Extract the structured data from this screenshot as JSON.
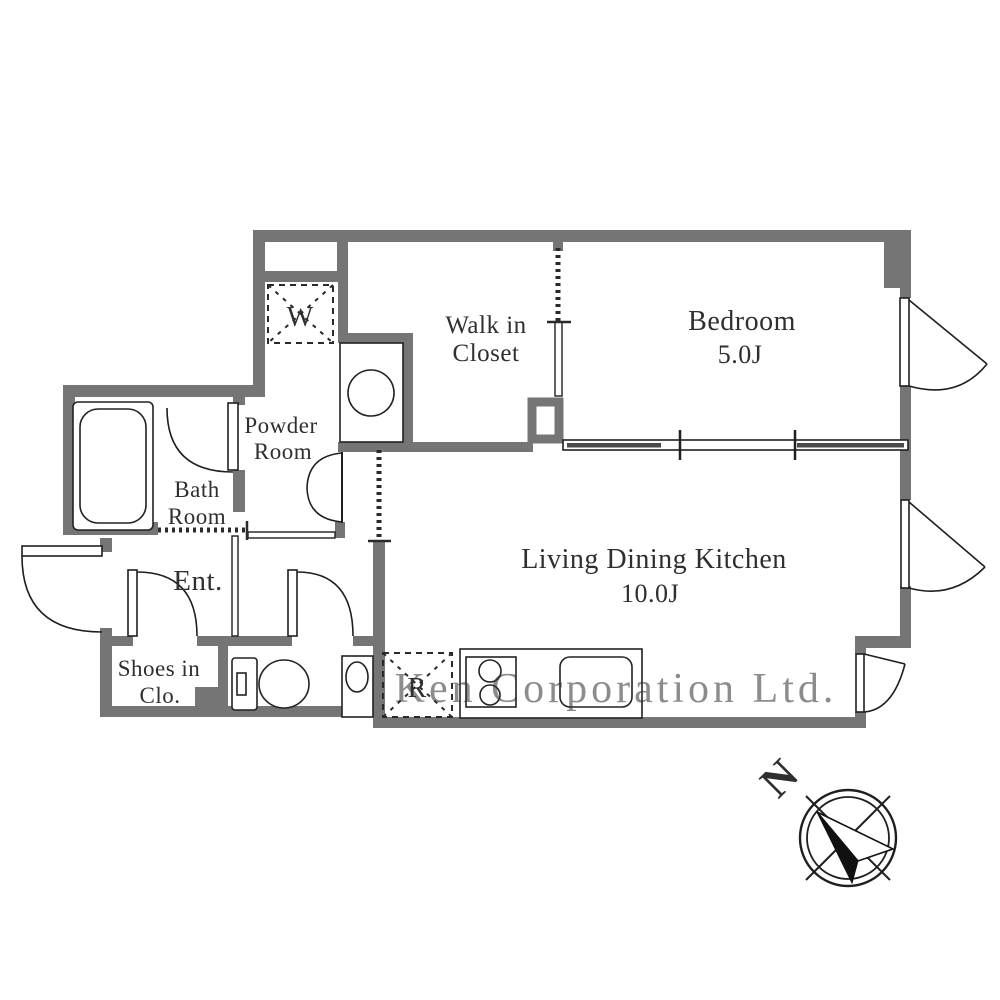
{
  "plan": {
    "watermark": "Ken Corporation Ltd.",
    "compass": {
      "north_label": "N"
    },
    "symbols": {
      "washing_machine": "W",
      "refrigerator": "R"
    },
    "rooms": {
      "bedroom": {
        "name": "Bedroom",
        "size": "5.0J"
      },
      "walk_in_closet": {
        "line1": "Walk in",
        "line2": "Closet"
      },
      "ldk": {
        "name": "Living Dining Kitchen",
        "size": "10.0J"
      },
      "powder_room": {
        "line1": "Powder",
        "line2": "Room"
      },
      "bath_room": {
        "line1": "Bath",
        "line2": "Room"
      },
      "entrance": {
        "name": "Ent."
      },
      "shoes_closet": {
        "line1": "Shoes in",
        "line2": "Clo."
      }
    },
    "colors": {
      "wall": "#757575",
      "line": "#1f1f1f",
      "text": "#2f2f2f",
      "watermark": "#c6c6c6"
    }
  }
}
